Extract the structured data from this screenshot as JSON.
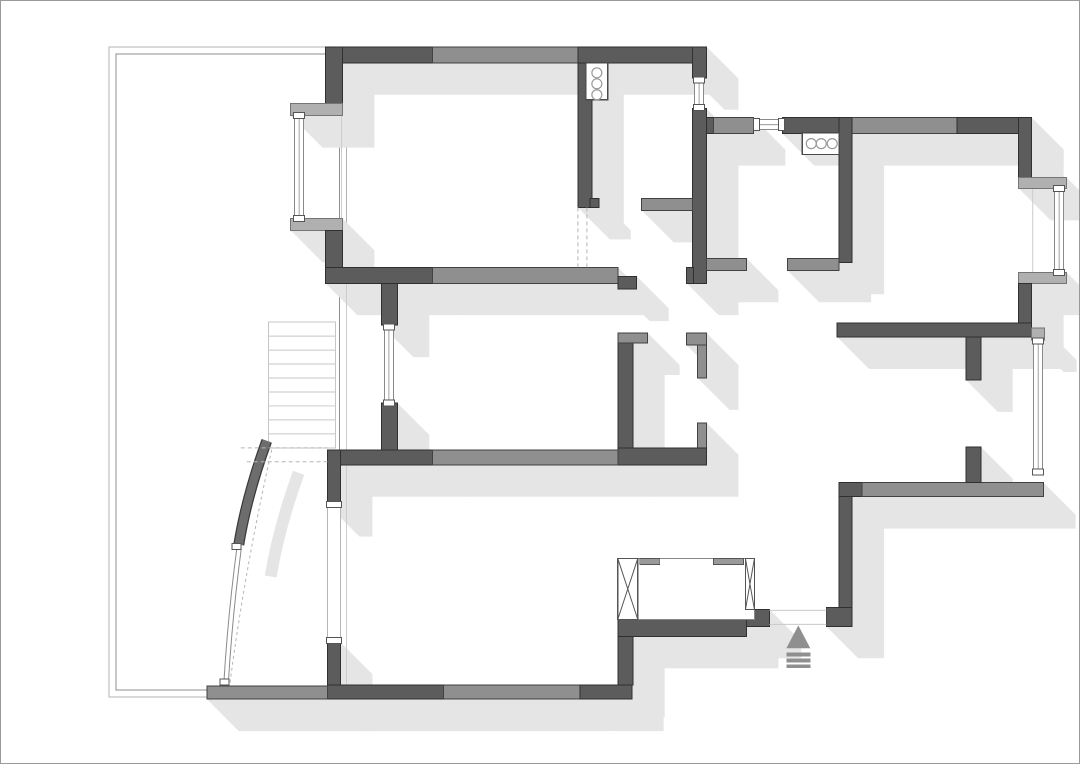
{
  "canvas": {
    "width": 1080,
    "height": 764
  },
  "colors": {
    "wall_dark": "#5c5c5c",
    "wall_dark_stroke": "#303030",
    "wall_mid": "#8f8f8f",
    "wall_mid_stroke": "#424242",
    "sill": "#b0b0b0",
    "sill_stroke": "#757575",
    "shadow": "#e5e5e6",
    "terrace_outer": "#b3b3b3",
    "terrace_inner": "#8f8f8f",
    "stairs": "#c6c6c6",
    "window_stroke": "#8a8a8a",
    "window_light": "#b5b5b5",
    "cap_stroke": "#555555",
    "fixture_stroke": "#4a4a4a",
    "fixture_circle": "#9a9a9a",
    "dash": "#b5b5b5",
    "thin_line": "#cccccc",
    "arrow": "#8f8f8f",
    "arc_dark": "#6d6d6d",
    "arc_edge": "#3a3a3a",
    "threshold": "#c9c9c9",
    "closet_stroke": "#888888",
    "closet_panel_stroke": "#555555",
    "closet_tick": "#9a9a9a"
  },
  "shadow_offset": 32,
  "terrace": {
    "outer": [
      108,
      46,
      238,
      652
    ],
    "inner": [
      115,
      53,
      224,
      638
    ]
  },
  "thin_lines": [
    [
      346,
      267,
      346,
      450
    ],
    [
      346,
      465,
      346,
      686
    ],
    [
      341,
      115,
      341,
      218
    ],
    [
      1034,
      188,
      1034,
      272
    ]
  ],
  "walls": [
    [
      325,
      46,
      107,
      16,
      "d"
    ],
    [
      432,
      46,
      146,
      16,
      "m"
    ],
    [
      578,
      46,
      129,
      16,
      "d"
    ],
    [
      325,
      46,
      17,
      59,
      "d"
    ],
    [
      290,
      103,
      52,
      12,
      "s"
    ],
    [
      290,
      218,
      52,
      12,
      "s"
    ],
    [
      325,
      230,
      17,
      53,
      "d"
    ],
    [
      325,
      267,
      107,
      16,
      "d"
    ],
    [
      432,
      267,
      186,
      16,
      "m"
    ],
    [
      618,
      276,
      19,
      13,
      "d"
    ],
    [
      578,
      62,
      14,
      145,
      "d"
    ],
    [
      590,
      198,
      9,
      9,
      "d"
    ],
    [
      693,
      46,
      14,
      31,
      "d"
    ],
    [
      693,
      108,
      14,
      175,
      "d"
    ],
    [
      687,
      267,
      7,
      16,
      "d"
    ],
    [
      642,
      198,
      51,
      12,
      "m"
    ],
    [
      707,
      117,
      10,
      16,
      "d"
    ],
    [
      714,
      117,
      40,
      16,
      "m"
    ],
    [
      783,
      117,
      70,
      16,
      "d"
    ],
    [
      853,
      117,
      105,
      16,
      "m"
    ],
    [
      958,
      117,
      75,
      16,
      "d"
    ],
    [
      1020,
      117,
      13,
      61,
      "d"
    ],
    [
      1020,
      177,
      48,
      11,
      "s"
    ],
    [
      1020,
      272,
      48,
      11,
      "s"
    ],
    [
      1020,
      283,
      13,
      54,
      "d"
    ],
    [
      840,
      117,
      13,
      145,
      "d"
    ],
    [
      707,
      258,
      40,
      12,
      "m"
    ],
    [
      788,
      258,
      52,
      12,
      "m"
    ],
    [
      838,
      323,
      195,
      14,
      "d"
    ],
    [
      1033,
      328,
      13,
      12,
      "s"
    ],
    [
      840,
      483,
      23,
      14,
      "d"
    ],
    [
      863,
      483,
      182,
      14,
      "m"
    ],
    [
      967,
      337,
      15,
      43,
      "d"
    ],
    [
      967,
      447,
      15,
      36,
      "d"
    ],
    [
      840,
      497,
      13,
      113,
      "d"
    ],
    [
      827,
      608,
      26,
      19,
      "d"
    ],
    [
      747,
      610,
      23,
      17,
      "d"
    ],
    [
      618,
      620,
      129,
      17,
      "d"
    ],
    [
      618,
      637,
      15,
      49,
      "d"
    ],
    [
      618,
      335,
      15,
      115,
      "d"
    ],
    [
      618,
      333,
      30,
      10,
      "m"
    ],
    [
      687,
      333,
      20,
      12,
      "m"
    ],
    [
      698,
      345,
      9,
      33,
      "m"
    ],
    [
      698,
      423,
      9,
      27,
      "m"
    ],
    [
      618,
      448,
      89,
      17,
      "d"
    ],
    [
      327,
      450,
      105,
      15,
      "d"
    ],
    [
      432,
      450,
      186,
      15,
      "m"
    ],
    [
      381,
      283,
      16,
      42,
      "d"
    ],
    [
      381,
      403,
      16,
      47,
      "d"
    ],
    [
      327,
      450,
      13,
      55,
      "d"
    ],
    [
      327,
      643,
      13,
      57,
      "d"
    ],
    [
      327,
      686,
      116,
      14,
      "d"
    ],
    [
      443,
      686,
      137,
      14,
      "m"
    ],
    [
      580,
      686,
      52,
      14,
      "d"
    ],
    [
      206,
      687,
      121,
      13,
      "m"
    ]
  ],
  "windows": [
    {
      "name": "window-left-bay",
      "o": "v",
      "r": [
        294,
        113,
        9,
        107
      ]
    },
    {
      "name": "window-top-small",
      "o": "v",
      "r": [
        695,
        77,
        9,
        32
      ]
    },
    {
      "name": "window-kitchen",
      "o": "h",
      "r": [
        755,
        119,
        29,
        10
      ]
    },
    {
      "name": "window-bedroom1-bay",
      "o": "v",
      "r": [
        1056,
        186,
        9,
        88
      ]
    },
    {
      "name": "window-bedroom2",
      "o": "v",
      "r": [
        1035,
        339,
        9,
        135
      ]
    },
    {
      "name": "window-middle-room",
      "o": "v",
      "r": [
        384,
        325,
        9,
        80
      ]
    },
    {
      "name": "balcony-door-opening",
      "o": "v",
      "r": [
        327,
        503,
        13,
        140
      ],
      "light": true
    }
  ],
  "fixtures": [
    {
      "name": "sink-fixture",
      "box": [
        586,
        62,
        22,
        37
      ],
      "circles": [
        [
          597,
          72
        ],
        [
          597,
          83
        ],
        [
          597,
          94
        ]
      ],
      "radius": 5
    },
    {
      "name": "stove-fixture",
      "box": [
        803,
        132,
        37,
        22
      ],
      "circles": [
        [
          812,
          143
        ],
        [
          822,
          143
        ],
        [
          833,
          143
        ]
      ],
      "radius": 5
    }
  ],
  "stairs": {
    "box": [
      268,
      322,
      67,
      126
    ],
    "treads": 8
  },
  "closet": {
    "box": [
      618,
      559,
      137,
      61
    ],
    "panels": [
      [
        618,
        559,
        20,
        61
      ],
      [
        746,
        559,
        9,
        51
      ]
    ],
    "ticks": [
      [
        640,
        559,
        20,
        6
      ],
      [
        714,
        559,
        30,
        6
      ]
    ]
  },
  "curved_door": {
    "band": "M266,441 Q246,496 238,545",
    "glass": [
      "M236,549 Q227,617 223,684",
      "M240.5,549 Q231.5,617 227.5,684"
    ],
    "caps": [
      [
        231,
        544,
        9,
        6
      ],
      [
        219,
        680,
        9,
        6
      ]
    ],
    "swing_dash": "M271,450 Q244,570 229,685"
  },
  "dashes": [
    [
      240,
      448,
      327,
      448
    ],
    [
      246,
      462,
      327,
      462
    ],
    [
      578,
      207,
      578,
      267
    ],
    [
      587,
      207,
      587,
      267
    ]
  ],
  "entry": {
    "arrow_icon": "entrance-arrow-icon",
    "triangle": "799,626 787,649 811,649",
    "bars": [
      [
        787,
        653,
        24,
        4
      ],
      [
        787,
        659,
        24,
        4
      ],
      [
        787,
        665,
        24,
        4
      ]
    ],
    "threshold": [
      [
        770,
        611,
        827,
        611
      ],
      [
        770,
        625,
        827,
        625
      ]
    ]
  }
}
